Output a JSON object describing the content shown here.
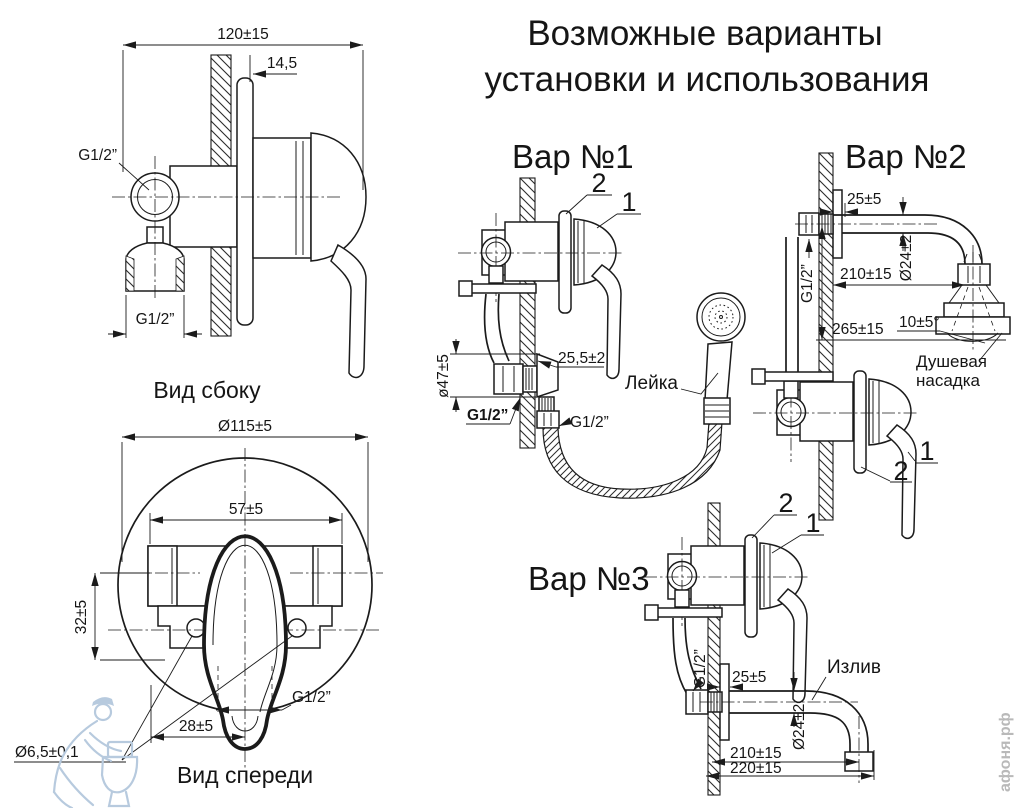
{
  "title": {
    "line1": "Возможные варианты",
    "line2": "установки и использования"
  },
  "side_view": {
    "caption": "Вид сбоку",
    "dim_width": "120±15",
    "dim_offset": "14,5",
    "thread_top": "G1/2”",
    "thread_bottom": "G1/2”"
  },
  "front_view": {
    "caption": "Вид спереди",
    "dim_diameter": "Ø115±5",
    "dim_width": "57±5",
    "dim_height": "32±5",
    "dim_offset": "28±5",
    "thread": "G1/2”",
    "dim_hole": "Ø6,5±0,1"
  },
  "variants": {
    "v1": {
      "heading": "Вар №1",
      "callout_1": "1",
      "callout_2": "2",
      "dim_depth": "25,5±2",
      "dim_flange": "ø47±5",
      "thread_wall": "G1/2”",
      "thread_hose": "G1/2”",
      "handset_label": "Лейка"
    },
    "v2": {
      "heading": "Вар №2",
      "callout_1": "1",
      "callout_2": "2",
      "dim_wall": "25±5",
      "dim_pipe": "Ø24±2",
      "dim_length": "210±15",
      "dim_height": "265±15",
      "dim_angle": "10±5°",
      "thread": "G1/2”",
      "head_label_1": "Душевая",
      "head_label_2": "насадка"
    },
    "v3": {
      "heading": "Вар №3",
      "callout_1": "1",
      "callout_2": "2",
      "dim_wall": "25±5",
      "dim_pipe": "Ø24±2",
      "dim_length": "210±15",
      "dim_length_full": "220±15",
      "thread": "G1/2”",
      "spout_label": "Излив"
    }
  },
  "watermark": {
    "site": "афоня.рф"
  },
  "colors": {
    "line": "#1b1b1b",
    "watermark_gray": "#b9b9b9",
    "watermark_blue": "#b7cade"
  }
}
